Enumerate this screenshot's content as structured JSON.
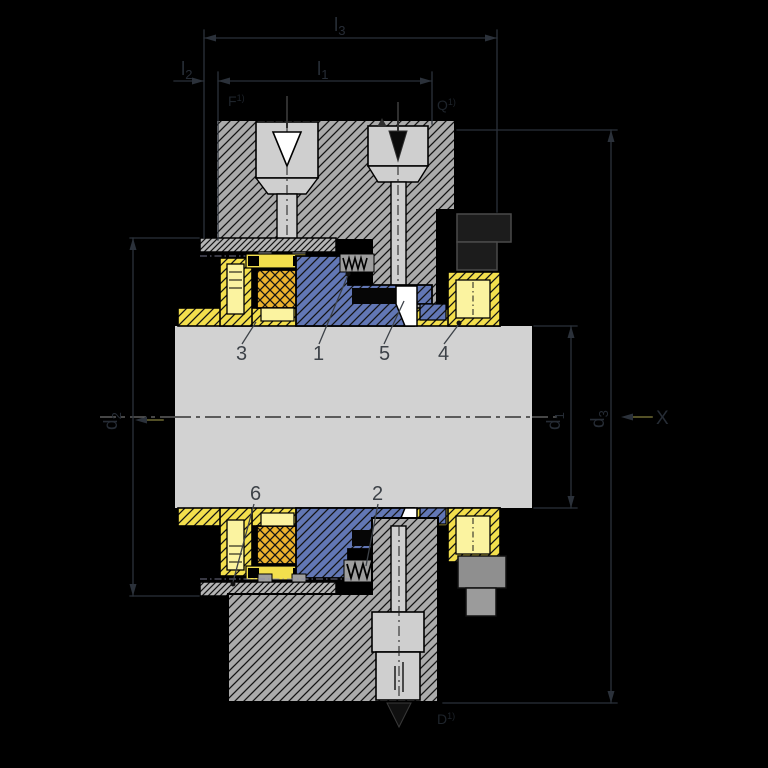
{
  "drawing": {
    "kind": "sectional-technical-drawing",
    "background": "#000000"
  },
  "labels": {
    "dims": {
      "l1": {
        "base": "l",
        "sub": "1"
      },
      "l2": {
        "base": "l",
        "sub": "2"
      },
      "l3": {
        "base": "l",
        "sub": "3"
      },
      "d1": {
        "base": "d",
        "sub": "1"
      },
      "d2": {
        "base": "d",
        "sub": "2"
      },
      "d3": {
        "base": "d",
        "sub": "3"
      },
      "view_arrow": "X"
    },
    "ports": {
      "top_left": {
        "base": "F",
        "sup": "1)"
      },
      "top_right": {
        "base": "Q",
        "sup": "1)"
      },
      "bottom": {
        "base": "D",
        "sup": "1)"
      }
    },
    "parts": [
      "1",
      "2",
      "3",
      "4",
      "5",
      "6"
    ]
  },
  "colors": {
    "background": "#000000",
    "shaft": "#d2d2d2",
    "bore": "#cfcfcf",
    "housing": "#ababab",
    "flange": "#b5b5b5",
    "sleeve_yellow": "#f3df4d",
    "pale_yellow": "#fbf3a0",
    "elastomer_gold": "#ecb32d",
    "seal_blue": "#6277b5",
    "white": "#ffffff",
    "dimension_line": "#2b313a",
    "part_label": "#3d4248",
    "arrow_tail_olive": "#6f6a33",
    "dark_arrow": "#101010"
  }
}
